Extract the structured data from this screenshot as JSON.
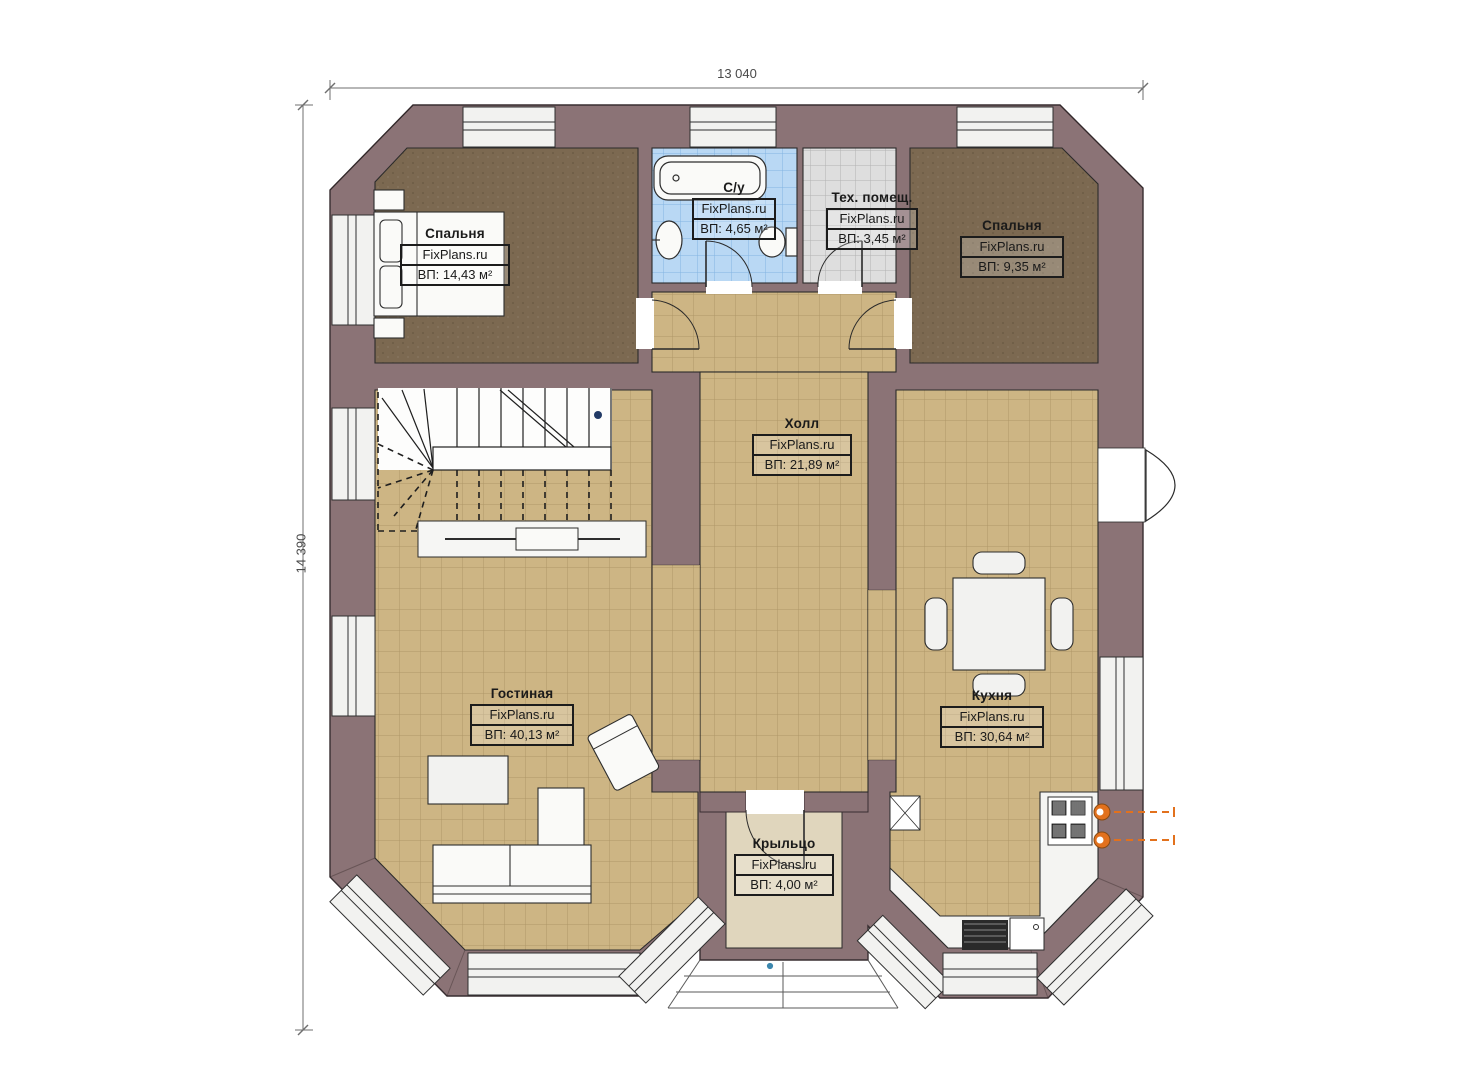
{
  "dimensions": {
    "top": "13 040",
    "left": "14 390"
  },
  "watermark": "FixPlans.ru",
  "rooms": [
    {
      "id": "bedroom-1",
      "name": "Спальня",
      "area": "ВП: 14,43 м²"
    },
    {
      "id": "bathroom",
      "name": "С/у",
      "area": "ВП: 4,65 м²"
    },
    {
      "id": "tech-room",
      "name": "Тех. помещ.",
      "area": "ВП: 3,45 м²"
    },
    {
      "id": "bedroom-2",
      "name": "Спальня",
      "area": "ВП: 9,35 м²"
    },
    {
      "id": "hall",
      "name": "Холл",
      "area": "ВП: 21,89 м²"
    },
    {
      "id": "living",
      "name": "Гостиная",
      "area": "ВП: 40,13 м²"
    },
    {
      "id": "kitchen",
      "name": "Кухня",
      "area": "ВП: 30,64 м²"
    },
    {
      "id": "porch",
      "name": "Крыльцо",
      "area": "ВП: 4,00 м²"
    }
  ],
  "colors": {
    "wall": "#8b7376",
    "floor_tile": "#cdb584",
    "carpet": "#7c6951",
    "bath_tile": "#b9d8f4",
    "tech_tile": "#dedede",
    "porch_floor": "#e0d6bd",
    "accent_orange": "#e2711d",
    "outline": "#2b2b2b"
  }
}
